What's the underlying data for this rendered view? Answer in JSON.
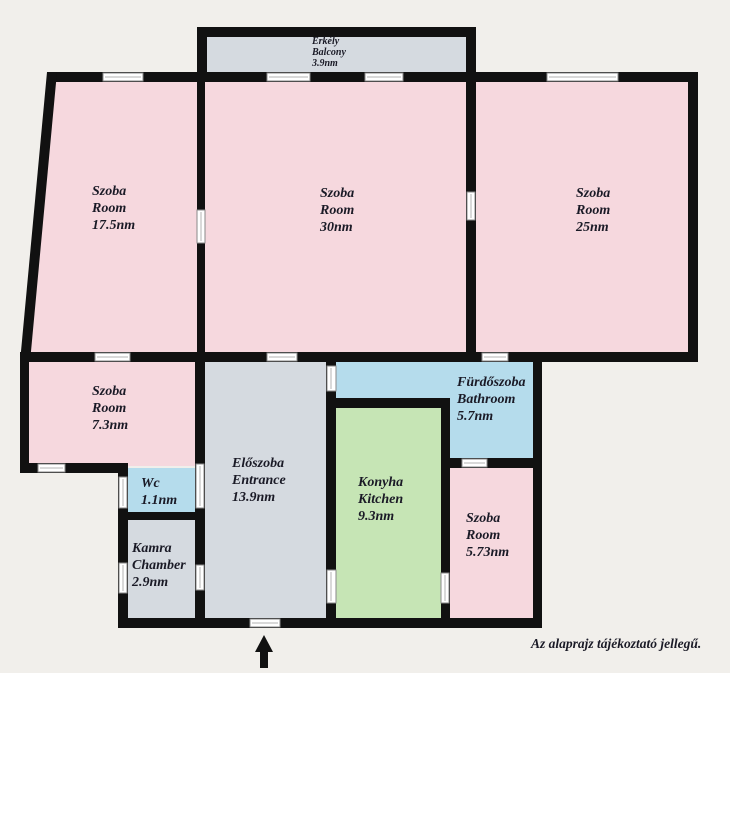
{
  "colors": {
    "room_pink": "#f6d8de",
    "wet_blue": "#b5dcec",
    "kitchen_green": "#c6e5b5",
    "hall_gray": "#d5dae0",
    "background_beige": "#f1efeb",
    "wall_black": "#111111",
    "text_ink": "#1a1a26"
  },
  "rooms": [
    {
      "id": "balcony",
      "name_hu": "Erkély",
      "name_en": "Balcony",
      "area": "3.9nm"
    },
    {
      "id": "room-17-5",
      "name_hu": "Szoba",
      "name_en": "Room",
      "area": "17.5nm"
    },
    {
      "id": "room-30",
      "name_hu": "Szoba",
      "name_en": "Room",
      "area": "30nm"
    },
    {
      "id": "room-25",
      "name_hu": "Szoba",
      "name_en": "Room",
      "area": "25nm"
    },
    {
      "id": "room-7-3",
      "name_hu": "Szoba",
      "name_en": "Room",
      "area": "7.3nm"
    },
    {
      "id": "entrance",
      "name_hu": "Előszoba",
      "name_en": "Entrance",
      "area": "13.9nm"
    },
    {
      "id": "wc",
      "name_hu": "Wc",
      "name_en": "",
      "area": "1.1nm"
    },
    {
      "id": "chamber",
      "name_hu": "Kamra",
      "name_en": "Chamber",
      "area": "2.9nm"
    },
    {
      "id": "bathroom",
      "name_hu": "Fürdőszoba",
      "name_en": "Bathroom",
      "area": "5.7nm"
    },
    {
      "id": "kitchen",
      "name_hu": "Konyha",
      "name_en": "Kitchen",
      "area": "9.3nm"
    },
    {
      "id": "room-5-73",
      "name_hu": "Szoba",
      "name_en": "Room",
      "area": "5.73nm"
    }
  ],
  "footnote": "Az alaprajz tájékoztató jellegű."
}
